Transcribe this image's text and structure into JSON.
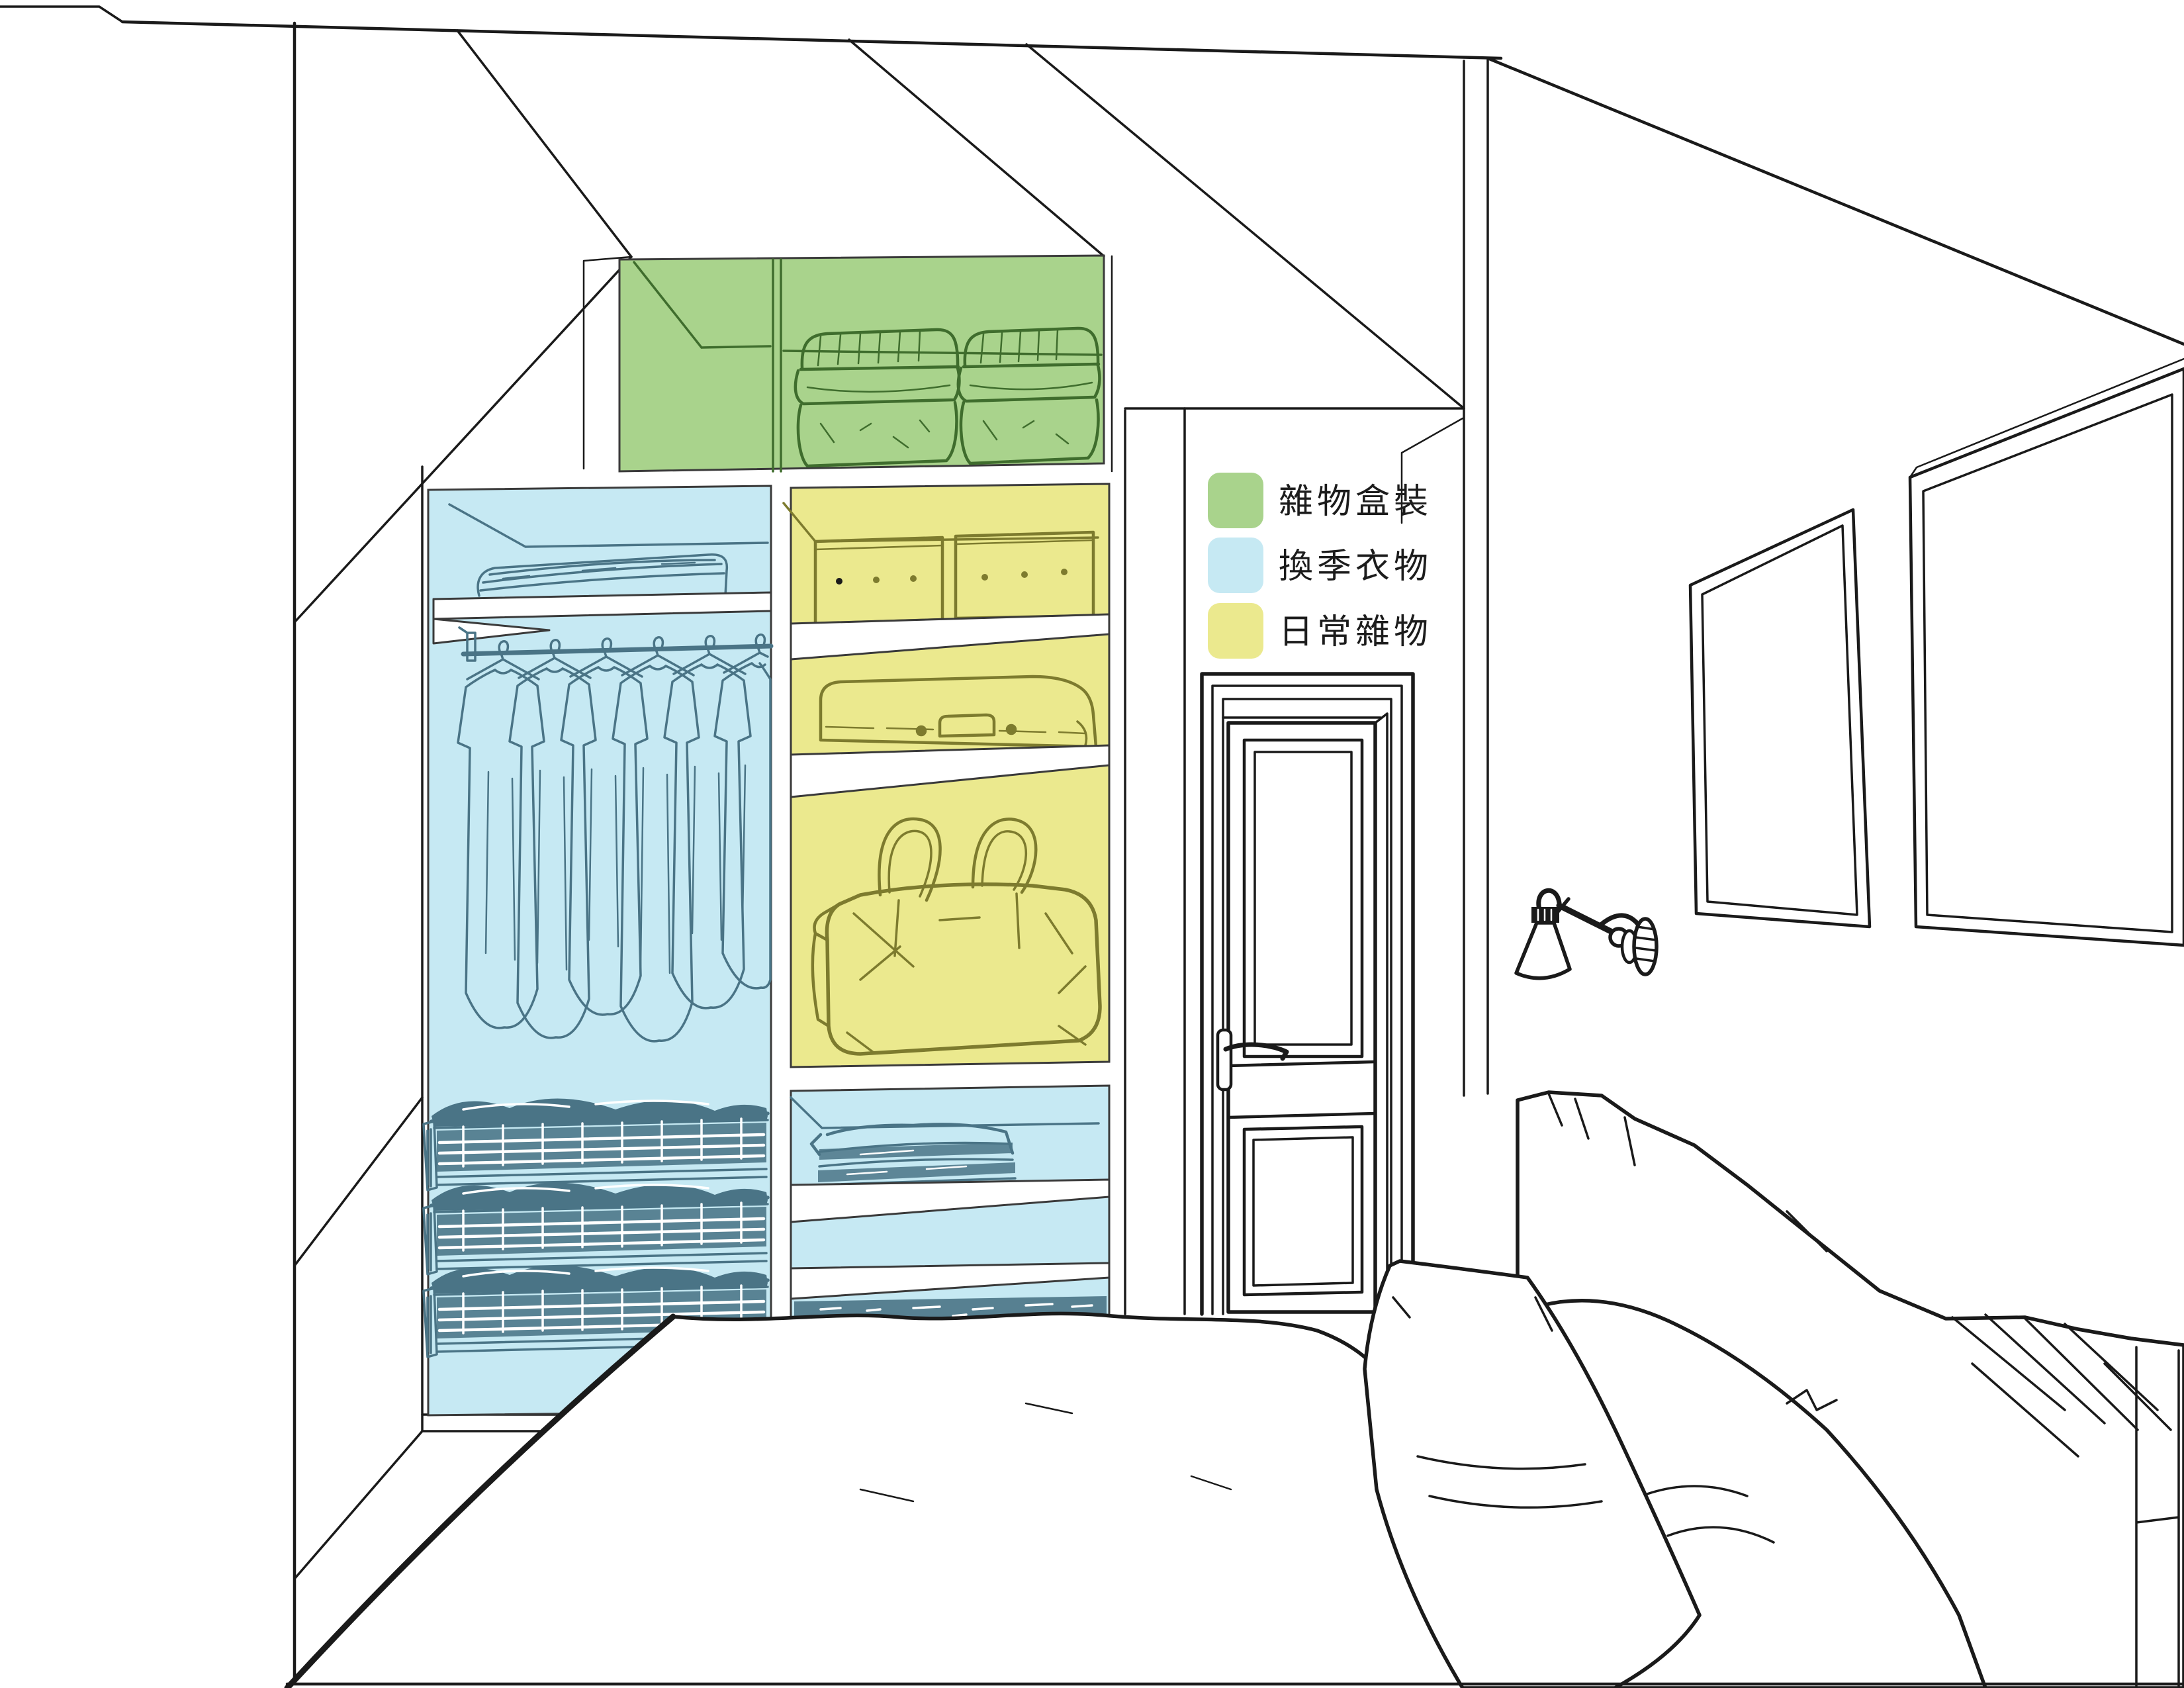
{
  "page": {
    "background": "#ffffff"
  },
  "colors": {
    "green": "#a9d38c",
    "blue": "#c6e9f3",
    "yellow": "#ebe98e",
    "green_line": "#3f6d2d",
    "blue_line": "#4a7486",
    "yellow_line": "#7d7b2e",
    "ink": "#1a1a1a",
    "cabinet_line": "#3a3a3a",
    "text": "#1c1c1c"
  },
  "legend": {
    "items": [
      {
        "id": "misc-boxed",
        "label": "雜物盒裝",
        "color": "#a9d38c"
      },
      {
        "id": "seasonal-clothing",
        "label": "換季衣物",
        "color": "#c6e9f3"
      },
      {
        "id": "daily-misc",
        "label": "日常雜物",
        "color": "#ebe98e"
      }
    ]
  }
}
